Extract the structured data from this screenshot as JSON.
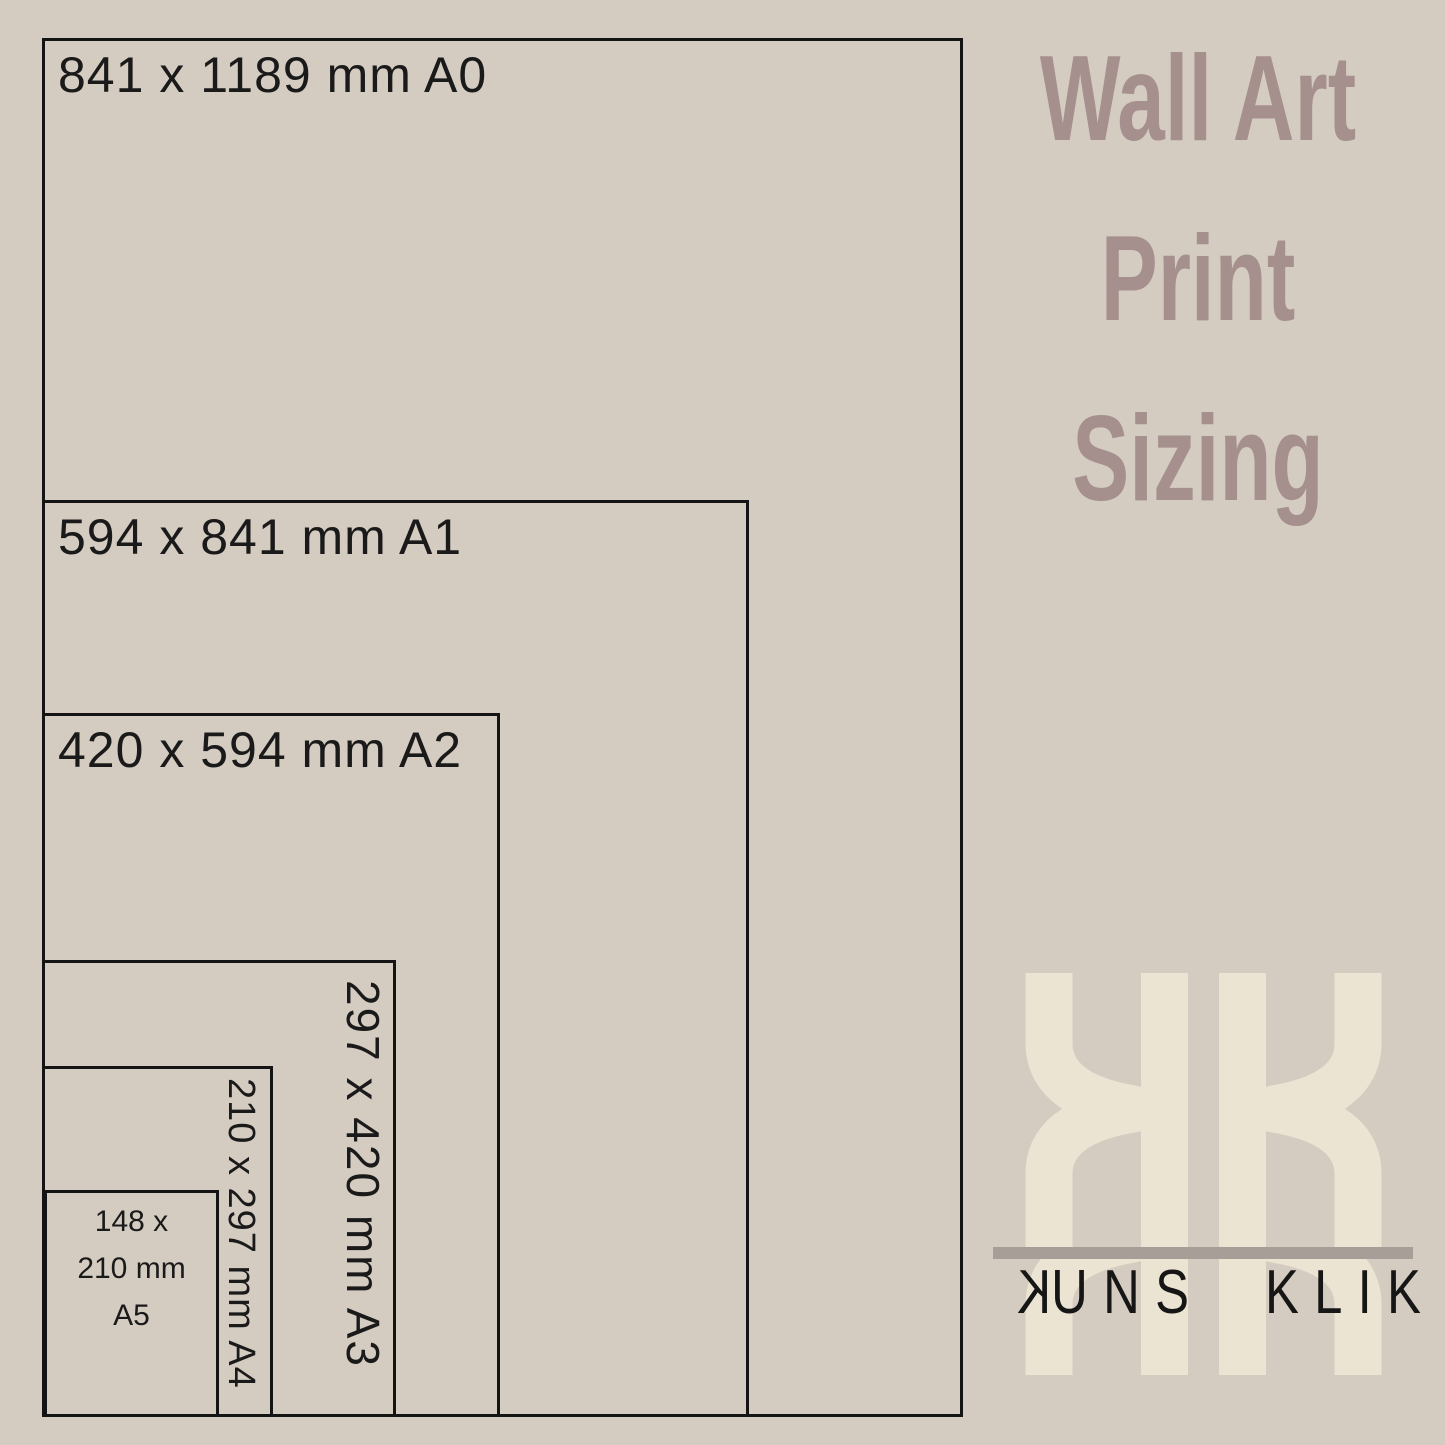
{
  "page": {
    "background_color": "#d5ccc1",
    "line_color": "#141414"
  },
  "title": {
    "lines": [
      "Wall Art",
      "Print",
      "Sizing"
    ],
    "color": "#a5908e"
  },
  "diagram": {
    "sizes": [
      {
        "code": "A0",
        "label": "841 x 1189 mm A0"
      },
      {
        "code": "A1",
        "label": "594 x 841 mm A1"
      },
      {
        "code": "A2",
        "label": "420 x 594 mm A2"
      },
      {
        "code": "A3",
        "label": "297 x 420 mm A3"
      },
      {
        "code": "A4",
        "label": "210 x 297 mm A4"
      },
      {
        "code": "A5",
        "label": "148 x 210 mm A5",
        "lines": [
          "148 x",
          "210 mm",
          "A5"
        ]
      }
    ]
  },
  "logo": {
    "monogram": "KK",
    "monogram_color": "#ece4d2",
    "bar_color": "#a89e98",
    "name_first_letter": "K",
    "name_first_rest": "UNS",
    "name_second": "KLIK",
    "text_color": "#161616"
  }
}
